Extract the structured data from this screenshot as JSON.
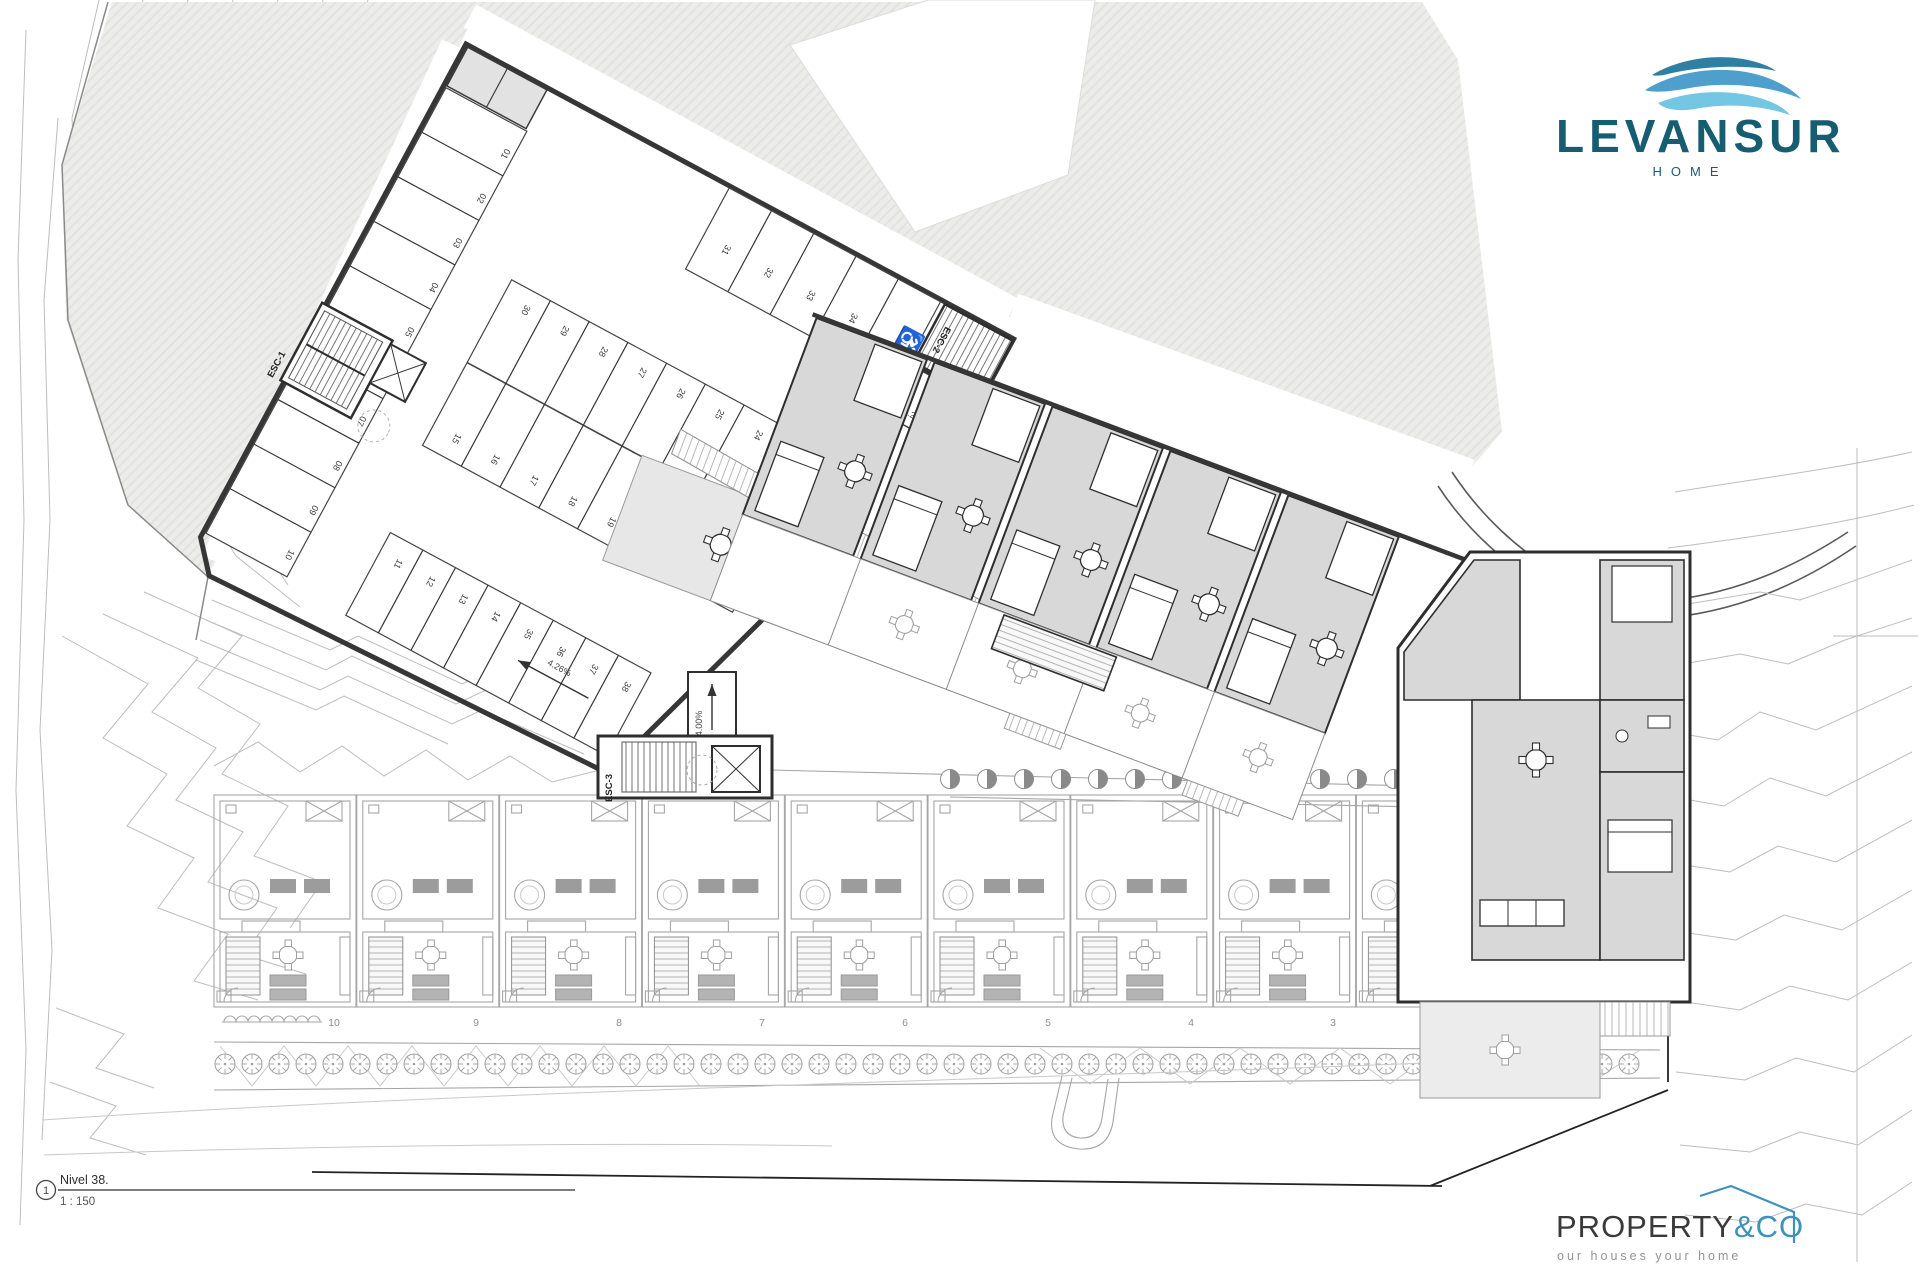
{
  "branding": {
    "levansur": {
      "name": "LEVANSUR",
      "subtitle": "HOME"
    },
    "property_co": {
      "primary": "PROPERTY",
      "accent": "&CO",
      "tagline": "our houses your home"
    }
  },
  "title_block": {
    "detail_number": "1",
    "level": "Nivel 38.",
    "scale": "1 : 150"
  },
  "plan": {
    "stairs": {
      "esc1": "ESC-1",
      "esc2": "ESC-2",
      "esc3": "ESC-3"
    },
    "ramps": {
      "aisle": "4.26%",
      "entry": "14.00%"
    },
    "icons": {
      "wheelchair": "♿"
    },
    "parking_stalls": {
      "left": [
        "01",
        "02",
        "03",
        "04",
        "05",
        "06",
        "07",
        "08",
        "09",
        "10"
      ],
      "spine_top": [
        "30",
        "29",
        "28",
        "27",
        "26",
        "25",
        "24",
        "23"
      ],
      "spine_bottom": [
        "15",
        "16",
        "17",
        "18",
        "19",
        "20",
        "21",
        "22"
      ],
      "lower": [
        "11",
        "12",
        "13",
        "14",
        "35",
        "36",
        "37",
        "38"
      ],
      "top_right": [
        "31",
        "32",
        "33",
        "34"
      ]
    },
    "townhouses": [
      "10",
      "9",
      "8",
      "7",
      "6",
      "5",
      "4",
      "3",
      "2",
      "1"
    ]
  },
  "colors": {
    "logo_teal": "#175d72",
    "wave_dark": "#2f7fa3",
    "wave_mid": "#4e9fcb",
    "wave_light": "#74c7e3",
    "propco_blue": "#3e92ba",
    "line_dark": "#363636",
    "room_fill": "#d8d8d8",
    "site_fill": "#ebebea"
  }
}
